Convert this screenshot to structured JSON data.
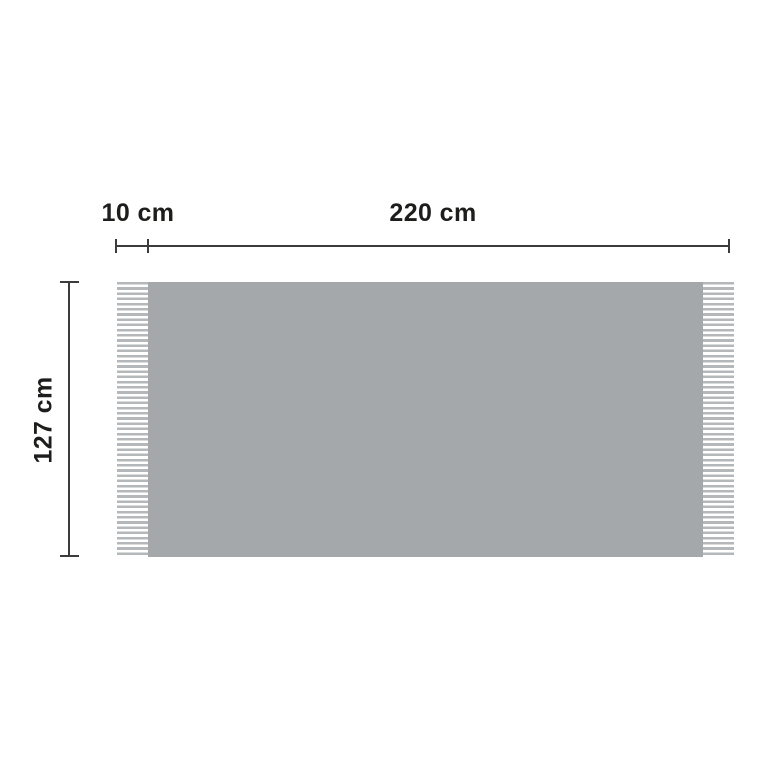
{
  "diagram": {
    "fringe_width_label": "10 cm",
    "width_label": "220 cm",
    "height_label": "127 cm"
  },
  "dimensions": {
    "fringe_width_cm": 10,
    "width_cm": 220,
    "height_cm": 127,
    "unit": "cm"
  },
  "colors": {
    "background": "#ffffff",
    "blanket_body": "#a5a8aa",
    "fringe_stripe": "#b5b8ba",
    "dimension_line": "#3c3c3b",
    "label_text": "#1d1d1b"
  }
}
